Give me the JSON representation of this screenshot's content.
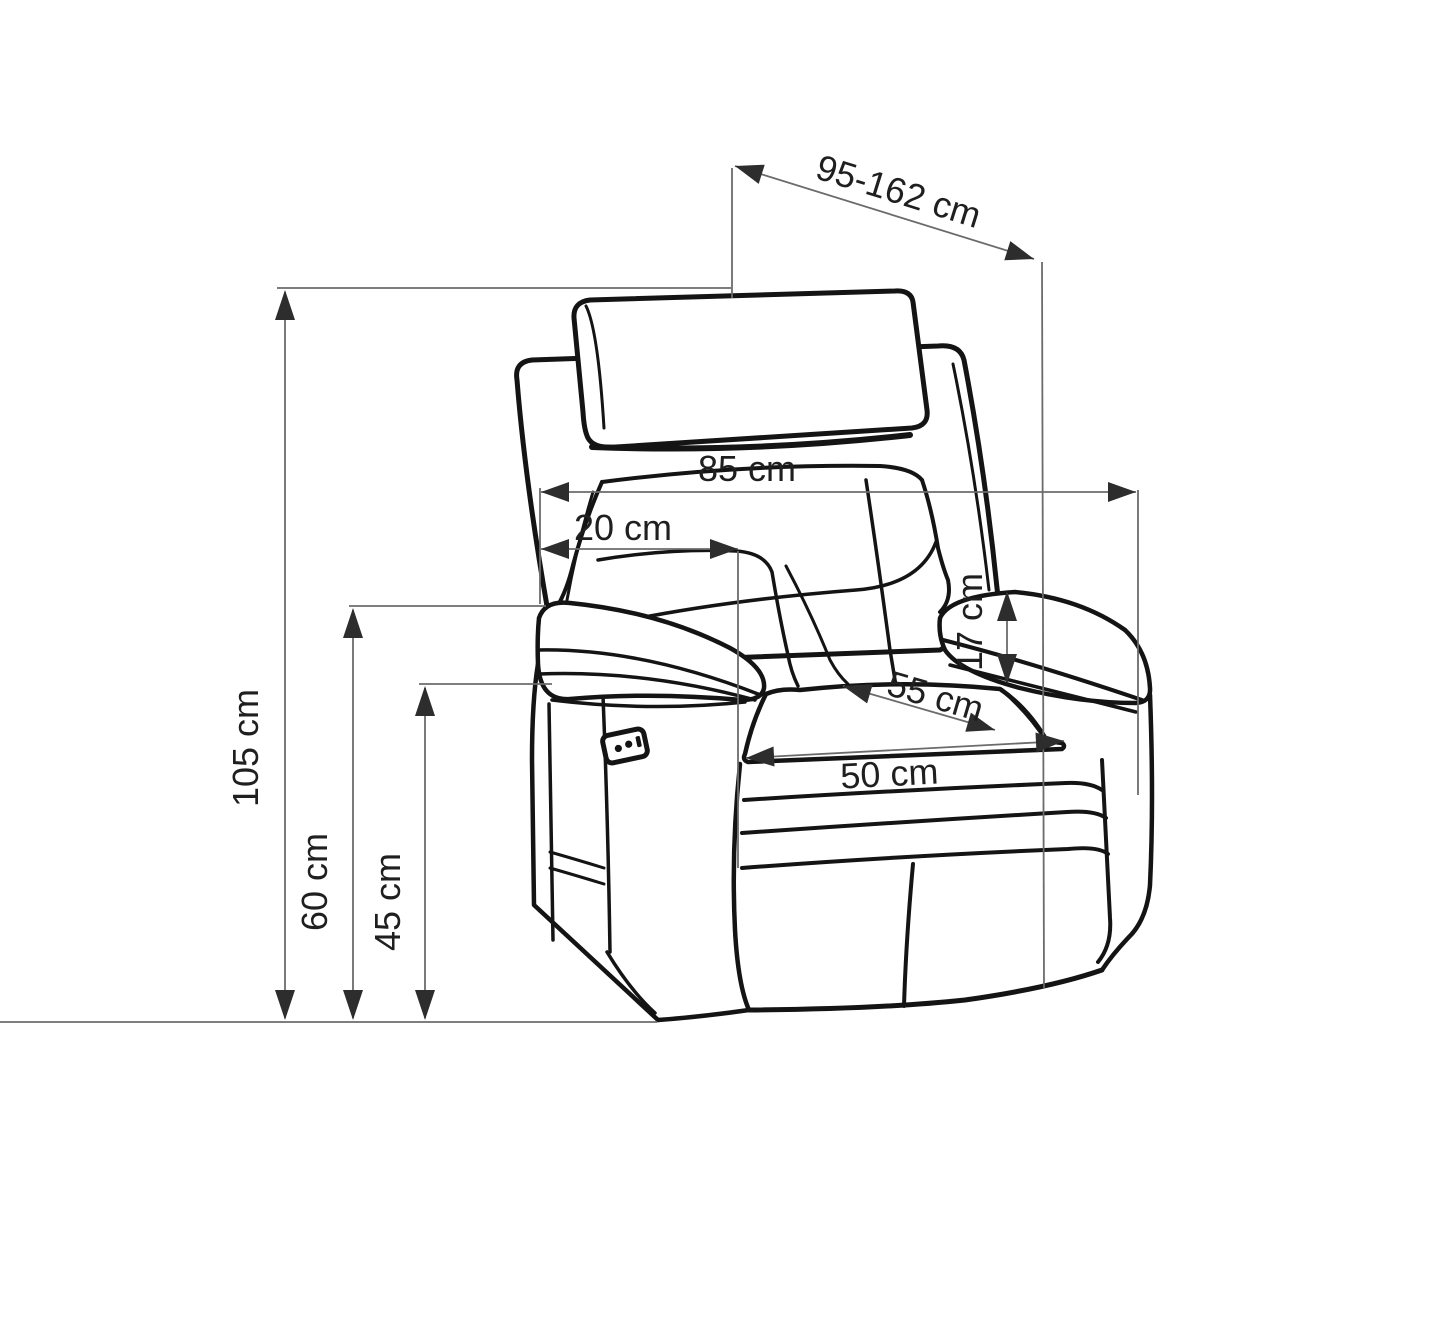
{
  "diagram": {
    "subject": "Recliner armchair technical line drawing with dimension annotations",
    "unit": "cm",
    "colors": {
      "background": "#ffffff",
      "outline": "#141414",
      "dimension_line": "#6b6b6b",
      "arrowhead": "#2d2d2d",
      "label_text": "#1f1f1f"
    },
    "labels": {
      "depth_range": "95-162 cm",
      "back_width": "85 cm",
      "back_side_depth": "20 cm",
      "armrest_above_seat_height": "17 cm",
      "seat_depth": "55 cm",
      "seat_width": "50 cm",
      "total_height": "105 cm",
      "armrest_height": "60 cm",
      "seat_height": "45 cm"
    }
  }
}
